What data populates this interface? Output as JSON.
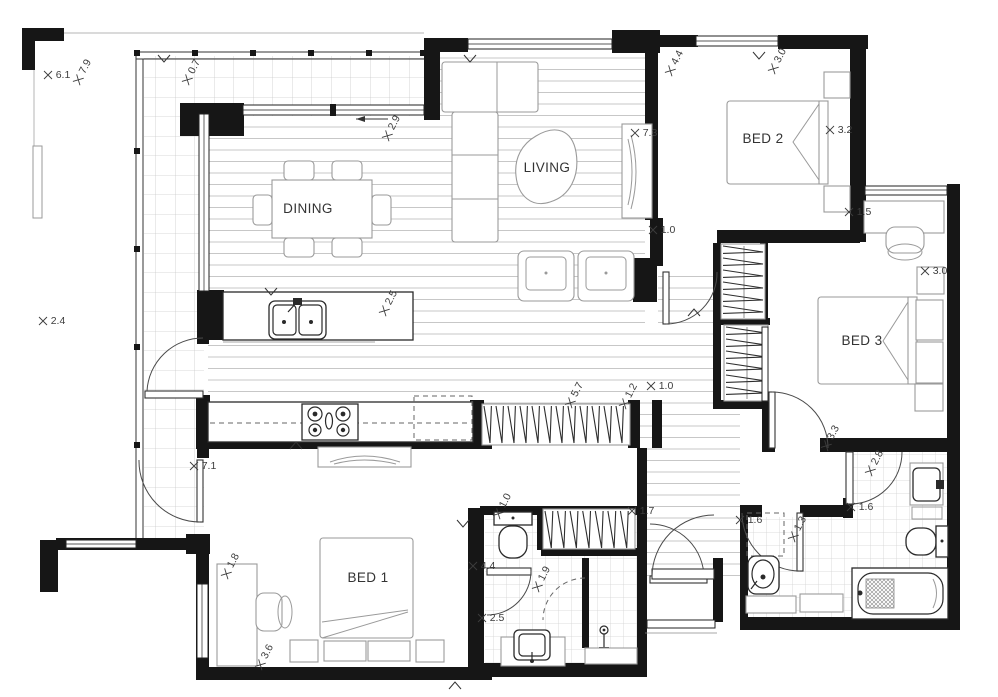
{
  "canvas": {
    "width": 998,
    "height": 697,
    "background": "#ffffff"
  },
  "colors": {
    "wall": "#161616",
    "hatch_balcony": "#cbcbcb",
    "hatch_wood": "#c7c7c7",
    "hatch_tile": "#d2d2d2",
    "furniture_line": "#9a9a9a",
    "fixture_line": "#2a2a2a",
    "label_text": "#333333",
    "dimension_text": "#3d3d3d"
  },
  "rooms": [
    {
      "t": "DINING",
      "x": 308,
      "y": 213
    },
    {
      "t": "LIVING",
      "x": 547,
      "y": 172
    },
    {
      "t": "BED 2",
      "x": 763,
      "y": 143
    },
    {
      "t": "BED 3",
      "x": 862,
      "y": 345
    },
    {
      "t": "BED 1",
      "x": 368,
      "y": 582
    }
  ],
  "dimensions": [
    {
      "t": "6.1",
      "x": 63,
      "y": 78,
      "r": 0
    },
    {
      "t": "7.9",
      "x": 88,
      "y": 68,
      "r": -62
    },
    {
      "t": "0.7",
      "x": 197,
      "y": 68,
      "r": -62
    },
    {
      "t": "2.9",
      "x": 397,
      "y": 124,
      "r": -62
    },
    {
      "t": "7.3",
      "x": 650,
      "y": 136,
      "r": 0
    },
    {
      "t": "4.4",
      "x": 680,
      "y": 59,
      "r": -62
    },
    {
      "t": "3.0",
      "x": 783,
      "y": 57,
      "r": -62
    },
    {
      "t": "3.2",
      "x": 845,
      "y": 133,
      "r": 0
    },
    {
      "t": "1.0",
      "x": 668,
      "y": 233,
      "r": 0
    },
    {
      "t": "1.5",
      "x": 864,
      "y": 215,
      "r": 0
    },
    {
      "t": "3.0",
      "x": 940,
      "y": 274,
      "r": 0
    },
    {
      "t": "2.4",
      "x": 58,
      "y": 324,
      "r": 0
    },
    {
      "t": "2.5",
      "x": 394,
      "y": 299,
      "r": -62
    },
    {
      "t": "5.7",
      "x": 580,
      "y": 391,
      "r": -62
    },
    {
      "t": "1.2",
      "x": 634,
      "y": 392,
      "r": -62
    },
    {
      "t": "1.0",
      "x": 666,
      "y": 389,
      "r": 0
    },
    {
      "t": "3.3",
      "x": 836,
      "y": 434,
      "r": -62
    },
    {
      "t": "7.1",
      "x": 209,
      "y": 469,
      "r": 0
    },
    {
      "t": "2.8",
      "x": 880,
      "y": 459,
      "r": -62
    },
    {
      "t": "1.6",
      "x": 866,
      "y": 510,
      "r": 0
    },
    {
      "t": "1.6",
      "x": 755,
      "y": 523,
      "r": 0
    },
    {
      "t": "1.3",
      "x": 803,
      "y": 525,
      "r": -62
    },
    {
      "t": "1.7",
      "x": 647,
      "y": 514,
      "r": 0
    },
    {
      "t": "1.0",
      "x": 508,
      "y": 502,
      "r": -62
    },
    {
      "t": "1.8",
      "x": 236,
      "y": 562,
      "r": -62
    },
    {
      "t": "4.4",
      "x": 488,
      "y": 569,
      "r": 0
    },
    {
      "t": "1.9",
      "x": 547,
      "y": 575,
      "r": -62
    },
    {
      "t": "2.5",
      "x": 497,
      "y": 621,
      "r": 0
    },
    {
      "t": "3.6",
      "x": 270,
      "y": 653,
      "r": -62
    }
  ],
  "wardrobes": [
    {
      "x": 484,
      "y": 406,
      "w": 144,
      "h": 37,
      "n": 12,
      "o": "h"
    },
    {
      "x": 723,
      "y": 246,
      "w": 40,
      "h": 72,
      "n": 6,
      "o": "v"
    },
    {
      "x": 726,
      "y": 327,
      "w": 40,
      "h": 72,
      "n": 6,
      "o": "v"
    },
    {
      "x": 545,
      "y": 511,
      "w": 88,
      "h": 37,
      "n": 7,
      "o": "h"
    }
  ]
}
